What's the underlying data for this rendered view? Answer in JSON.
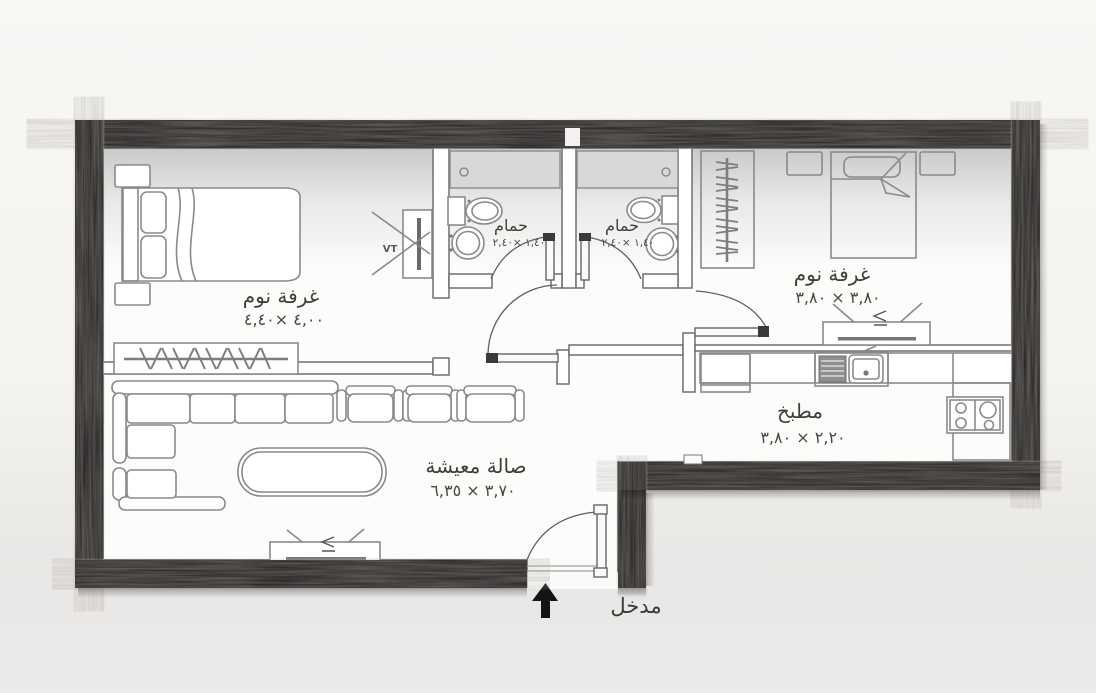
{
  "plan": {
    "entrance_label": "مدخل",
    "tv_mark": "VT",
    "rooms": {
      "bedroom_left": {
        "name": "غرفة نوم",
        "dims": "٤,٠٠ ×٤,٤٠"
      },
      "bedroom_right": {
        "name": "غرفة نوم",
        "dims": "٣,٨٠ × ٣,٨٠"
      },
      "bathroom_left": {
        "name": "حمام",
        "dims": "١,٤٠ ×٢,٤٠"
      },
      "bathroom_right": {
        "name": "حمام",
        "dims": "١,٤٠ ×٢,٤٠"
      },
      "kitchen": {
        "name": "مطبخ",
        "dims": "٢,٢٠ × ٣,٨٠"
      },
      "living": {
        "name": "صالة معيشة",
        "dims": "٣,٧٠ × ٦,٣٥"
      }
    },
    "colors": {
      "outer_wall": "#211f1e",
      "floor": "#fcfcfb",
      "furniture_line": "#8a8a8a",
      "text": "#403e3b",
      "shower_fill": "#d8d8d8"
    }
  }
}
